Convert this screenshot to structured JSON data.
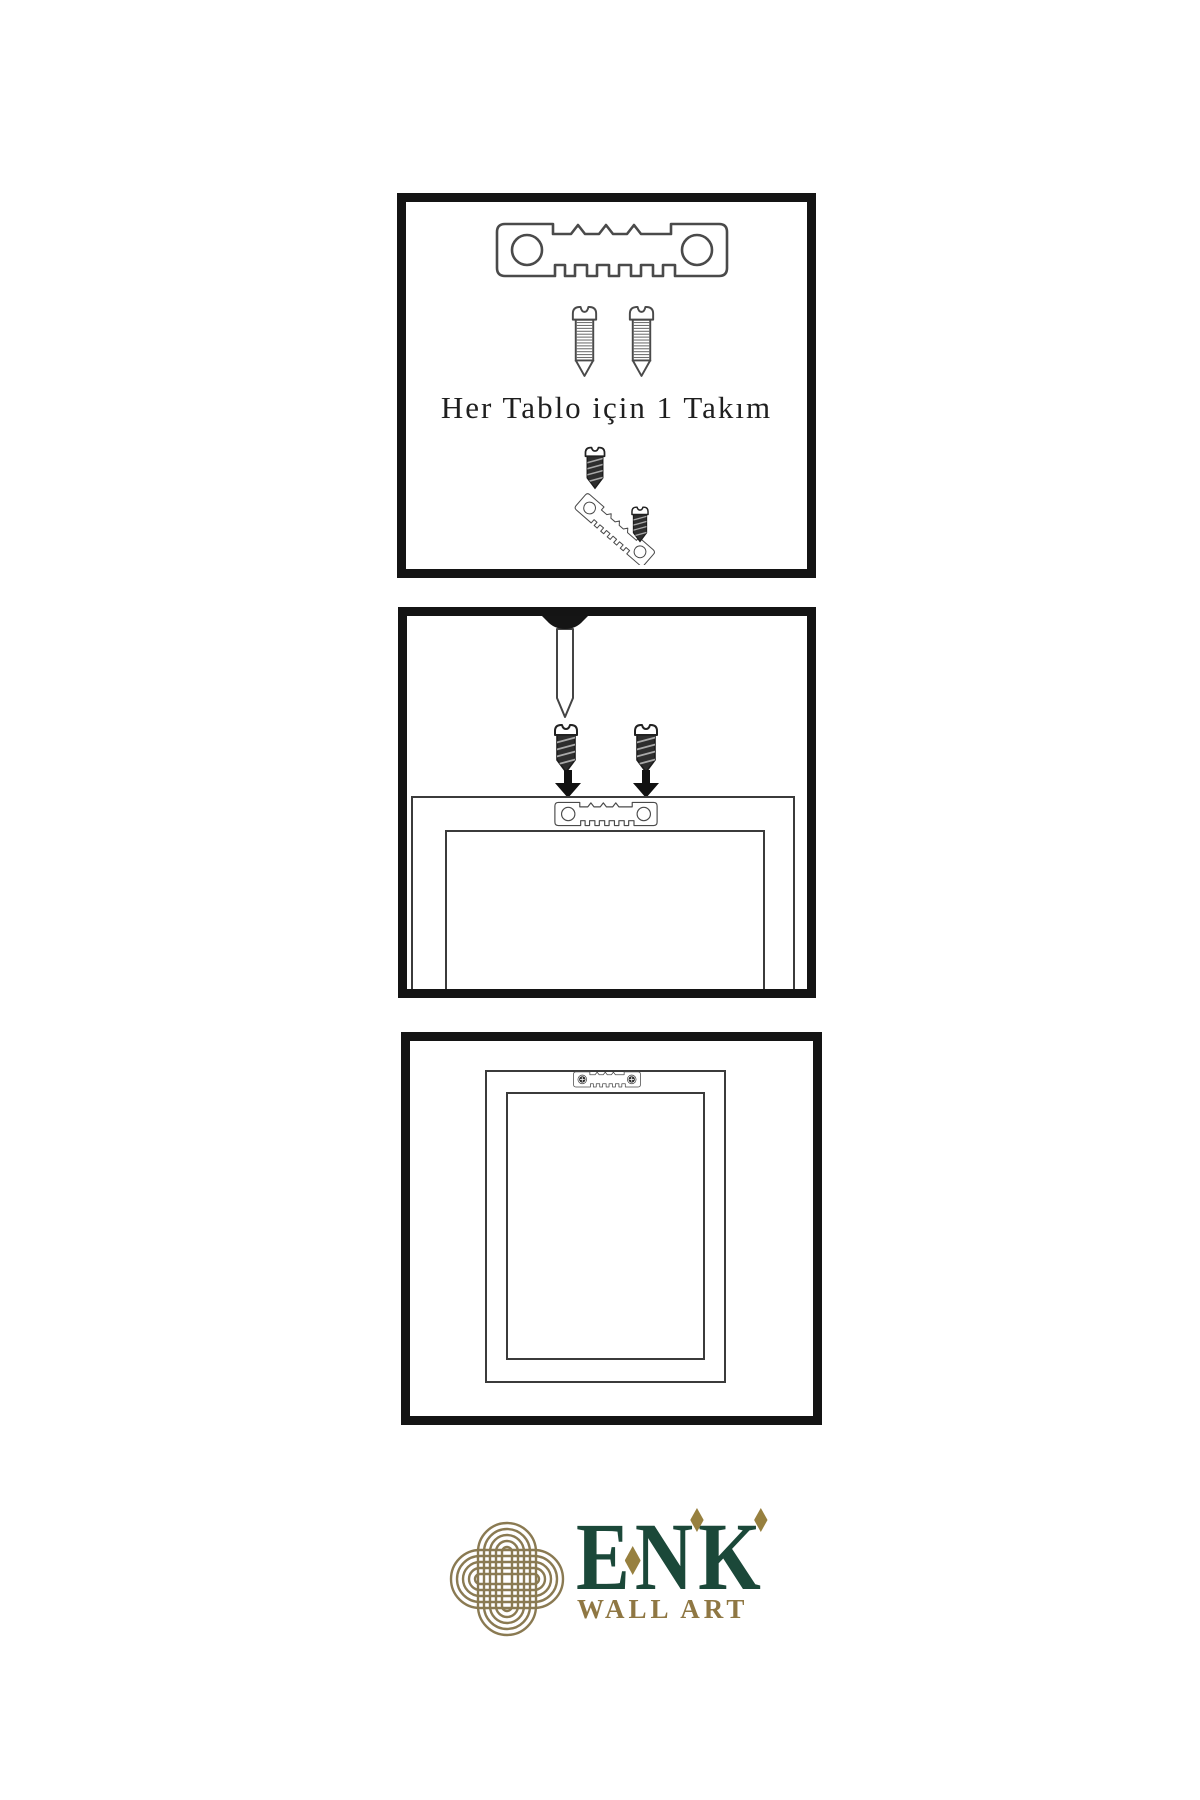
{
  "step1": {
    "caption": "Her Tablo için 1 Takım"
  },
  "logo": {
    "letters": [
      "E",
      "N",
      "K"
    ],
    "subtitle": "WALL ART",
    "colors": {
      "green": "#1b4839",
      "gold": "#97803f",
      "knot": "#8a7a52"
    }
  },
  "panels": {
    "count": 3,
    "border_color": "#141414",
    "line_color": "#4a4a4a"
  },
  "icons": {
    "hanger": "sawtooth-hanger-icon",
    "screw_outline": "screw-outline-icon",
    "screw_dark": "screw-dark-icon",
    "nail": "nail-icon",
    "arrow": "arrow-down-icon",
    "knot": "knot-logo-icon"
  }
}
